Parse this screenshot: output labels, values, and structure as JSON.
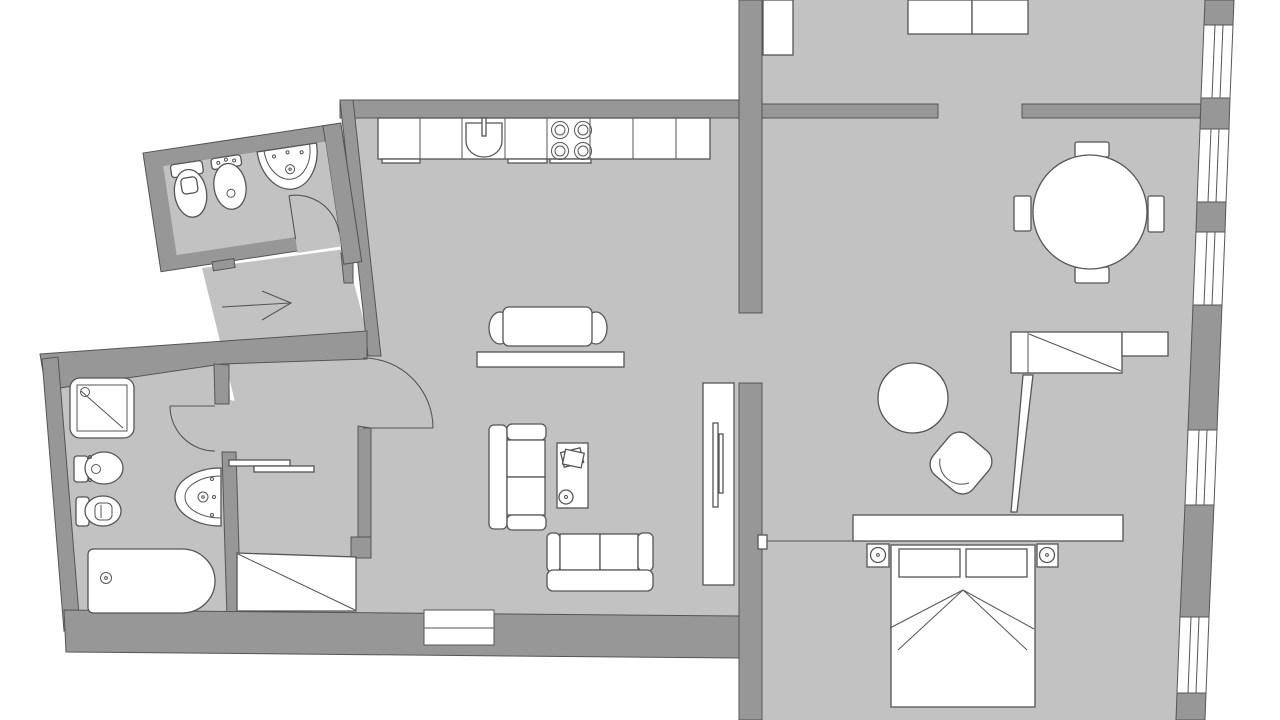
{
  "title": "Apartment floor plan (top view, no text labels)",
  "canvas": {
    "width": 1280,
    "height": 720
  },
  "colors": {
    "background": "#ffffff",
    "floor": "#c2c2c2",
    "wall": "#979797",
    "outline": "#555555",
    "furniture": "#ffffff"
  },
  "legend": {
    "floor_meaning": "light gray = interior floor",
    "wall_meaning": "dark gray = walls",
    "white_meaning": "white shapes = fixtures / furniture / windows"
  },
  "rooms": [
    {
      "id": "wc",
      "label": "Guest WC (tilted room, top-left)",
      "fixtures": [
        "toilet",
        "bidet",
        "washbasin",
        "door-swing"
      ]
    },
    {
      "id": "hallway",
      "label": "Entrance hall",
      "fixtures": [
        "entry-arrow"
      ]
    },
    {
      "id": "kitchen",
      "label": "Kitchen zone",
      "fixtures": [
        "counter-7-units",
        "kitchen-sink",
        "cooktop-4-burners",
        "island-table",
        "stool-left",
        "stool-right",
        "bench"
      ]
    },
    {
      "id": "dining",
      "label": "Dining room (top-right)",
      "fixtures": [
        "round-table",
        "chair-top",
        "chair-bottom",
        "chair-left",
        "chair-right",
        "wall-cabinet-left",
        "wall-cabinet-a",
        "wall-cabinet-b"
      ]
    },
    {
      "id": "bathroom",
      "label": "Bathroom (bottom-left)",
      "fixtures": [
        "shower-tray",
        "toilet",
        "bidet",
        "washbasin",
        "bathtub",
        "door-swing"
      ]
    },
    {
      "id": "closet",
      "label": "Storage / closet room",
      "fixtures": [
        "shelf-bar-a",
        "shelf-bar-b",
        "storage-unit-diagonal"
      ]
    },
    {
      "id": "living",
      "label": "Living room",
      "fixtures": [
        "sofa-vertical",
        "sofa-horizontal",
        "desk",
        "papers",
        "stool",
        "tv-cabinet",
        "french-window"
      ]
    },
    {
      "id": "bedroom",
      "label": "Bedroom (bottom-right)",
      "fixtures": [
        "double-bed",
        "pillow-left",
        "pillow-right",
        "nightstand-left",
        "nightstand-right",
        "lamp-left",
        "lamp-right",
        "long-cabinet",
        "wardrobe",
        "wardrobe-open-door",
        "sliding-door",
        "round-side-table",
        "chair"
      ]
    }
  ],
  "windows": {
    "right_band_count": 5,
    "bottom_wall_count": 1,
    "style": "white with thin mullion lines, set in slanted outer wall"
  },
  "doors": {
    "swing_arcs": 3,
    "sliding": 1,
    "openings": 3
  },
  "entry": {
    "symbol": "arrow pointing right into the hallway"
  }
}
